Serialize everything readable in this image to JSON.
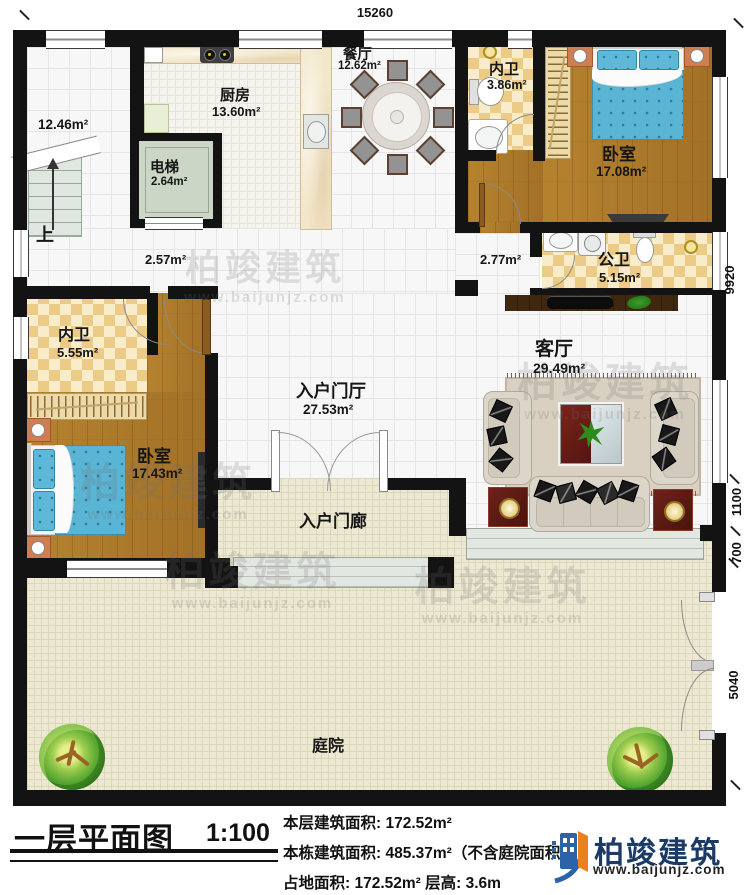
{
  "plan": {
    "dim_top": "15260",
    "dim_right_upper": "9920",
    "dim_right_1100": "1100",
    "dim_right_700": "700",
    "dim_right_lower": "5040",
    "labels": {
      "up": "上",
      "stairhall_area": "12.46m²",
      "hall_left_area": "2.57m²",
      "hall_right_area": "2.77m²"
    },
    "rooms": {
      "kitchen": {
        "name": "厨房",
        "area": "13.60m²"
      },
      "dining": {
        "name": "餐厅",
        "area": "12.62m²"
      },
      "elevator": {
        "name": "电梯",
        "area": "2.64m²"
      },
      "ensuite_top": {
        "name": "内卫",
        "area": "3.86m²"
      },
      "bedroom_right": {
        "name": "卧室",
        "area": "17.08m²"
      },
      "public_bath": {
        "name": "公卫",
        "area": "5.15m²"
      },
      "ensuite_left": {
        "name": "内卫",
        "area": "5.55m²"
      },
      "bedroom_left": {
        "name": "卧室",
        "area": "17.43m²"
      },
      "entry_hall": {
        "name": "入户门厅",
        "area": "27.53m²"
      },
      "living_room": {
        "name": "客厅",
        "area": "29.49m²"
      },
      "porch": {
        "name": "入户门廊"
      },
      "courtyard": {
        "name": "庭院"
      }
    }
  },
  "titleblock": {
    "title": "一层平面图",
    "scale": "1:100",
    "floor_area_line": "本层建筑面积: 172.52m²",
    "total_area_line": "本栋建筑面积: 485.37m²（不含庭院面积）",
    "footprint_line": "占地面积: 172.52m²  层高: 3.6m"
  },
  "brand": {
    "name": "柏竣建筑",
    "url": "www.baijunjz.com"
  },
  "watermark": {
    "name": "柏竣建筑",
    "url": "www.baijunjz.com"
  },
  "colors": {
    "wall": "#131313",
    "wood": "#a9782c",
    "checker": "#ecc27c",
    "courtyard": "#ece8d2",
    "bed_blue": "#5ab4d4",
    "logo_blue": "#2a63a8",
    "logo_orange": "#e8821e"
  }
}
